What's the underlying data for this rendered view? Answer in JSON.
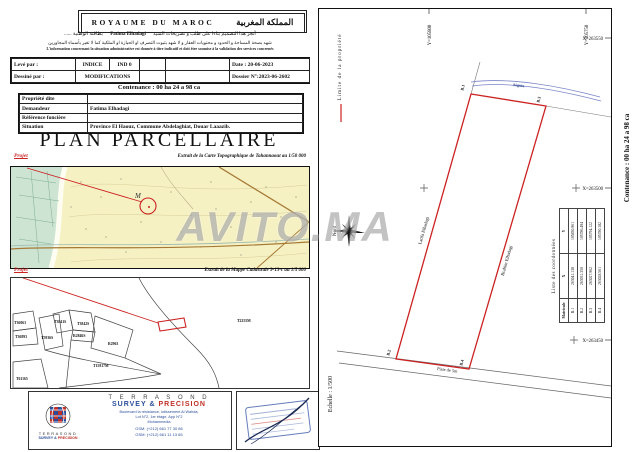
{
  "header": {
    "title_fr": "ROYAUME  DU  MAROC",
    "title_ar": "المملكة المغربية"
  },
  "attestation": {
    "line1_pre": "أنجز هذا التصميم بناءا على طلب و تصريحات السيد",
    "name": "Fatima Elhadagi",
    "line1_post": "بطاقته الوطنية ......",
    "line2": "شهد بصحة المساحة و الحدود و محتويات العقار و لا شهد بثبوت التصرف او الحيازة او الملكية كما لا تغير بأسماء المجاورين",
    "line3": "L'information concernant la situation administrative est donnée à titre indicatif et doit être soumise à la validation des services concernés"
  },
  "info_table": {
    "leve_par": "Levé par :",
    "indice": "INDICE",
    "ind0": "IND 0",
    "date": "Date : 20-06-2023",
    "dessine_par": "Dessiné par :",
    "modifications": "MODIFICATIONS",
    "dossier": "Dossier N°:2023-06-2602"
  },
  "contenance": "Contenance : 00 ha 24 a 98 ca",
  "property": {
    "rows": [
      {
        "label": "Propriété dite",
        "value": ""
      },
      {
        "label": "Demandeur",
        "value": "Fatima Elhadagi"
      },
      {
        "label": "Référence foncière",
        "value": ""
      },
      {
        "label": "Situation",
        "value": "Province El Haouz, Commune Abdelaghiat, Douar Laaazib."
      }
    ]
  },
  "title": "PLAN  PARCELLAIRE",
  "topo_map": {
    "projet": "Projet",
    "caption": "Extrait de la Carte Topographique de Tahannaout au 1/50 000",
    "marker_label": "M"
  },
  "cadastral_map": {
    "projet": "Projet",
    "caption": "Extrait de la Mappe Cadastrale  9-13-c  au 1/5 000",
    "parcels": [
      "T36063",
      "T36893",
      "T3841S",
      "T3842S",
      "T5936S",
      "R2846S",
      "R2963",
      "T15817M",
      "T61165",
      "T2255M"
    ]
  },
  "watermark": "AVITO.MA",
  "drawing": {
    "legend_limite": "Limite  de  la  propriété",
    "scale": "Echelle  :  1/500",
    "north": "Nord",
    "side_contenance": "Contenance : 00 ha 24 a 98 ca",
    "y_ticks": [
      "Y=105800",
      "Y=105750"
    ],
    "x_ticks": [
      "X=263550",
      "X=263500",
      "X=263450"
    ],
    "points": {
      "b1": "B.1",
      "b2": "B.2",
      "b3": "B.3",
      "b4": "B.4"
    },
    "neighbor_left": "Latifa Elhadagi",
    "neighbor_right": "Brahim Elhadagi",
    "road": "Piste de 5m",
    "channel": "Séguia",
    "coords": {
      "title": "Liste  des  coordonnées",
      "headers": [
        "Matricule",
        "X",
        "Y"
      ],
      "rows": [
        [
          "B.1",
          "263041.138",
          "105830.961"
        ],
        [
          "B.2",
          "263031.350",
          "105786.494"
        ],
        [
          "B.3",
          "263027.962",
          "105794.122"
        ],
        [
          "B.4",
          "263028.561",
          "105780.182"
        ]
      ]
    }
  },
  "footer": {
    "logo_line1": "TERRASOND",
    "logo_line2a": "SURVEY &",
    "logo_line2b": "PRECISION",
    "company_1": "T E R R A S O N D",
    "company_2a": "SURVEY &",
    "company_2b": "PRECISION",
    "address1": "Boulevard la résistance, lotissement Al Wahda,",
    "address2": "Lot N°2, 1er étage, App N°2",
    "address3": "Mohammedia",
    "gsm1": "GSM: (+212) 661 77 30 86",
    "gsm2": "GSM: (+212) 661 11 13 65"
  }
}
